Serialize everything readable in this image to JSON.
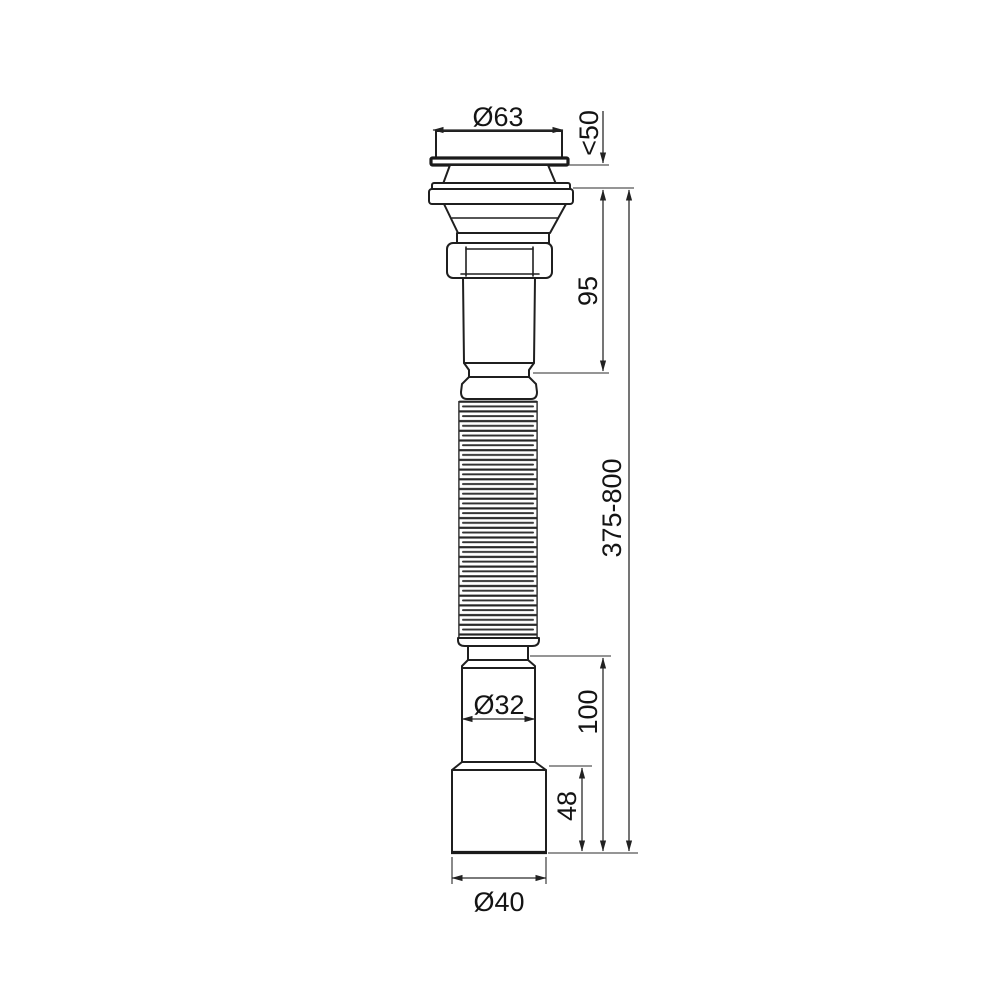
{
  "drawing": {
    "dimensions": {
      "top_diameter": "Ø63",
      "strainer_height_max": "<50",
      "upper_body_height": "95",
      "hose_length_range": "375-800",
      "outlet_pipe_diameter": "Ø32",
      "outlet_assembly_height": "100",
      "outlet_sleeve_height": "48",
      "outlet_end_diameter": "Ø40"
    },
    "colors": {
      "background": "#ffffff",
      "part_line": "#1f1f1f",
      "dimension_line": "#2b2b2b",
      "text": "#141414"
    }
  }
}
